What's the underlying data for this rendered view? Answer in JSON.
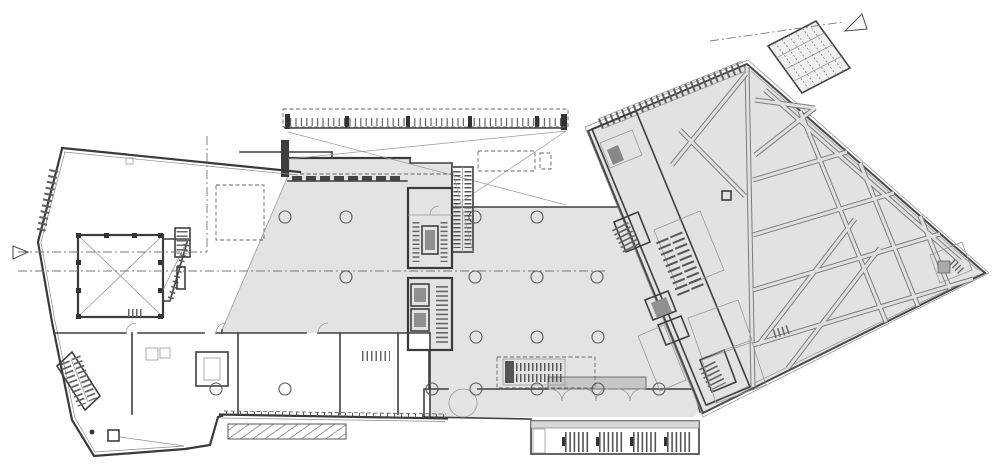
{
  "drawing": {
    "kind": "architectural-floor-plan",
    "colors": {
      "background": "#ffffff",
      "wall_line": "#3f3f3f",
      "floor_gray": "#e3e3e3",
      "wing_gray": "#e2e2e2",
      "vestibule_gray": "#c6c6c6",
      "dark_fixture": "#909090",
      "hatch": "#666666"
    },
    "features": [
      "west-block",
      "auditorium-void-room",
      "stage-trapezoid",
      "switchback-stair",
      "central-hall",
      "escalator-core",
      "elevator-core",
      "entry-canopy",
      "skylight-dashed-boxes",
      "wardrobe-counter",
      "south-entrance-doors",
      "revolving-swing-door",
      "external-south-stair",
      "ramp-hatch-strip",
      "diagonal-wing",
      "service-band",
      "truss-lattice",
      "skylight-grid-panel",
      "section-markers",
      "column-grid",
      "grid-lines"
    ],
    "columns": {
      "radius": 6,
      "points": [
        [
          285,
          217
        ],
        [
          346,
          217
        ],
        [
          475,
          217
        ],
        [
          537,
          217
        ],
        [
          346,
          277
        ],
        [
          475,
          277
        ],
        [
          537,
          277
        ],
        [
          597,
          277
        ],
        [
          476,
          337
        ],
        [
          537,
          337
        ],
        [
          598,
          337
        ],
        [
          216,
          389
        ],
        [
          285,
          389
        ],
        [
          432,
          389
        ],
        [
          476,
          389
        ],
        [
          537,
          389
        ],
        [
          598,
          389
        ],
        [
          659,
          389
        ]
      ]
    },
    "small_columns": {
      "radius": 2.4,
      "points": [
        [
          92,
          432
        ]
      ]
    },
    "grid_lines": [
      [
        18,
        252,
        207,
        252
      ],
      [
        18,
        271,
        607,
        271
      ],
      [
        207,
        136,
        207,
        252
      ],
      [
        710,
        41,
        843,
        22
      ]
    ],
    "sight_lines": [
      [
        288,
        132,
        566,
        205
      ],
      [
        288,
        159,
        566,
        131
      ],
      [
        452,
        208,
        566,
        131
      ]
    ],
    "dashed_boxes": [
      [
        283,
        109,
        285,
        18
      ],
      [
        478,
        151,
        57,
        20
      ],
      [
        540,
        153,
        11,
        16
      ],
      [
        497,
        357,
        98,
        31
      ],
      [
        216,
        185,
        48,
        55
      ]
    ],
    "dashed_lines": [
      [
        300,
        174,
        452,
        174
      ],
      [
        224,
        411,
        446,
        414
      ]
    ],
    "section_markers": [
      {
        "name": "section-marker-northeast",
        "points": "845,31 862,14 867,29"
      },
      {
        "name": "section-marker-west",
        "points": "13,246 28,252 13,259"
      }
    ]
  }
}
